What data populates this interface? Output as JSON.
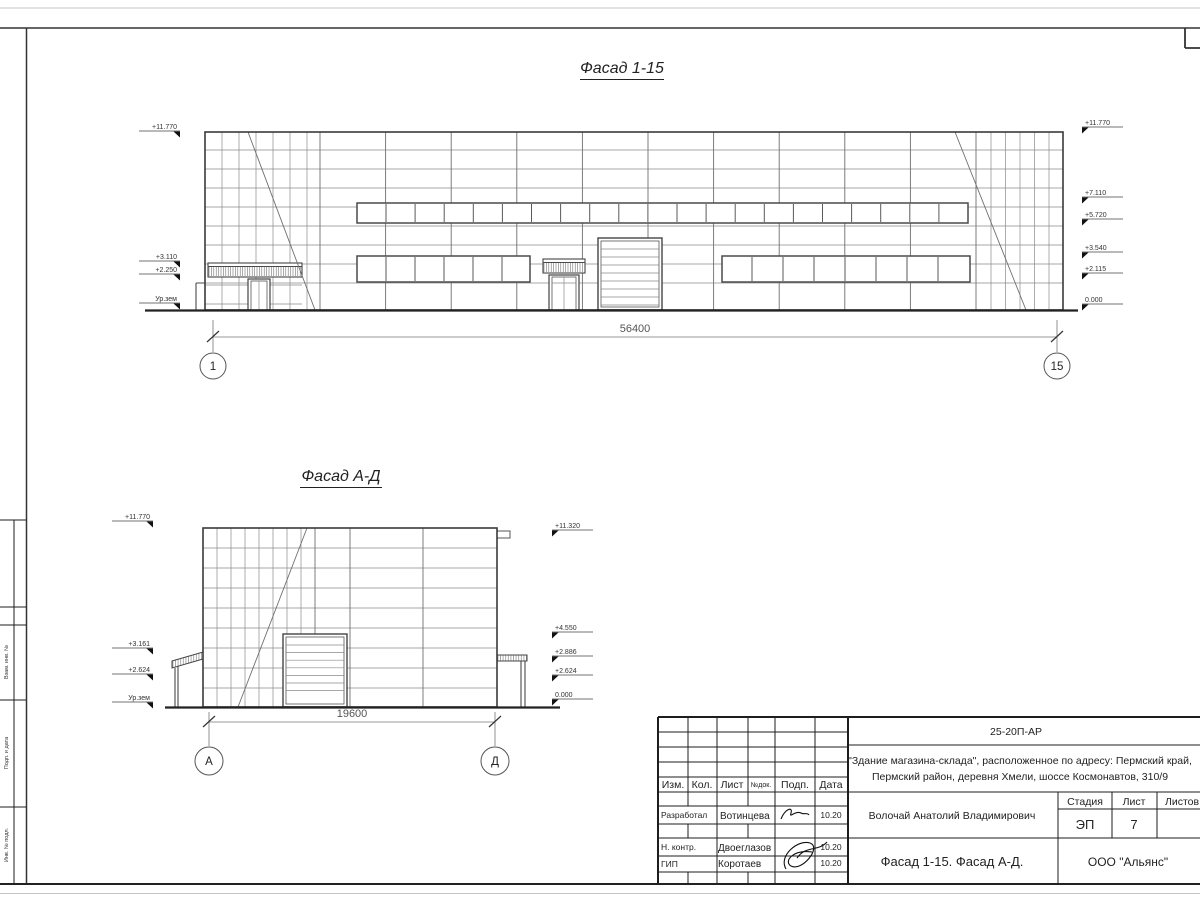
{
  "palette": {
    "line": "#6b6b6b",
    "dark": "#222222",
    "paper": "#ffffff"
  },
  "f1": {
    "title": "Фасад 1-15",
    "dim": "56400",
    "axis_left": "1",
    "axis_right": "15",
    "marks_left": [
      "+11.770",
      "+3.110",
      "+2.250",
      "Ур.зем"
    ],
    "marks_right": [
      "+11.770",
      "+7.110",
      "+5.720",
      "+3.540",
      "+2.115",
      "0.000"
    ]
  },
  "f2": {
    "title": "Фасад А-Д",
    "dim": "19600",
    "axis_left": "А",
    "axis_right": "Д",
    "marks_left": [
      "+11.770",
      "+3.161",
      "+2.624",
      "Ур.зем"
    ],
    "marks_right": [
      "+11.320",
      "+4.550",
      "+2.886",
      "+2.624",
      "0.000"
    ]
  },
  "frame": {
    "side_labels": [
      "Взам. инв. №",
      "Подп. и дата",
      "Инв. № подл."
    ]
  },
  "tb": {
    "doc": "25-20П-АР",
    "proj1": "\"Здание магазина-склада\", расположенное по адресу: Пермский край,",
    "proj2": "Пермский район, деревня Хмели, шоссе Космонавтов, 310/9",
    "h": {
      "izm": "Изм.",
      "kol": "Кол.",
      "list": "Лист",
      "ndok": "№док.",
      "podp": "Подп.",
      "data": "Дата"
    },
    "rows": [
      {
        "role": "Разработал",
        "name": "Вотинцева",
        "date": "10.20"
      },
      {
        "role": "Н. контр.",
        "name": "Двоеглазов",
        "date": "10.20"
      },
      {
        "role": "ГИП",
        "name": "Коротаев",
        "date": "10.20"
      }
    ],
    "chief": "Волочай Анатолий Владимирович",
    "stage_l": "Стадия",
    "list_l": "Лист",
    "listov_l": "Листов",
    "stage": "ЭП",
    "sheet": "7",
    "title": "Фасад 1-15. Фасад А-Д.",
    "company": "ООО \"Альянс\""
  }
}
